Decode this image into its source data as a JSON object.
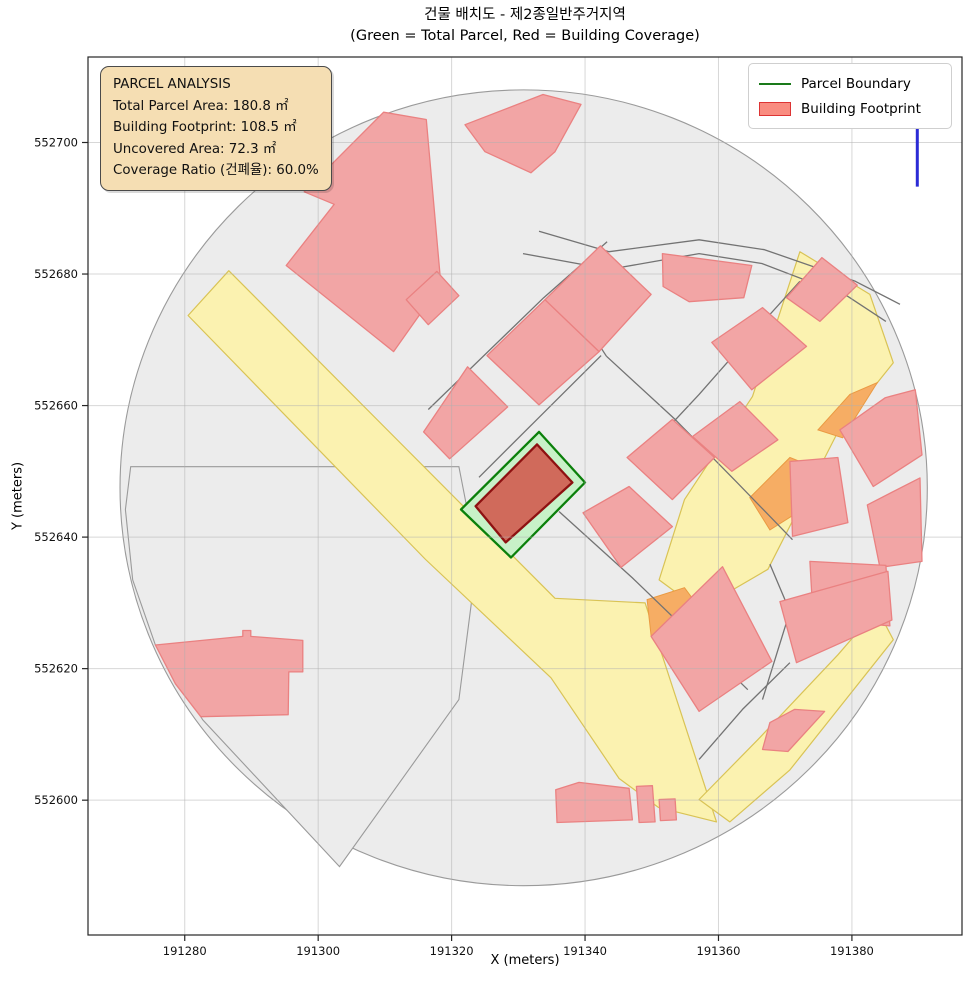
{
  "chart_data": {
    "type": "area",
    "subtype": "cadastral-parcel-map",
    "title": "건물 배치도 - 제2종일반주거지역",
    "subtitle": "(Green = Total Parcel, Red = Building Coverage)",
    "xlabel": "X (meters)",
    "ylabel": "Y (meters)",
    "xlim": [
      191265.5,
      191396.5
    ],
    "ylim": [
      552579.5,
      552713.0
    ],
    "xticks": [
      191280,
      191300,
      191320,
      191340,
      191360,
      191380
    ],
    "yticks": [
      552600,
      552620,
      552640,
      552660,
      552680,
      552700
    ],
    "grid": true,
    "legend": {
      "position": "top-right",
      "entries": [
        {
          "label": "Parcel Boundary",
          "type": "line",
          "color": "#1a7a1a"
        },
        {
          "label": "Building Footprint",
          "type": "patch",
          "color": "#f98c80",
          "edge": "#dd3434"
        }
      ]
    },
    "annotation_box": {
      "bg": "#f5deb3",
      "lines": [
        "PARCEL ANALYSIS",
        "Total Parcel Area: 180.8 ㎡",
        "Building Footprint: 108.5 ㎡",
        "Uncovered Area: 72.3 ㎡",
        "Coverage Ratio (건폐율): 60.0%"
      ]
    },
    "stats": {
      "total_parcel_area_m2": 180.8,
      "building_footprint_m2": 108.5,
      "uncovered_area_m2": 72.3,
      "coverage_ratio_pct": 60.0,
      "zoning": "제2종일반주거지역"
    },
    "north_arrow": {
      "label": "N",
      "x": 191389.8,
      "y_top": 552703.0,
      "y_bottom": 552693.3,
      "line_color": "#2b2bd6",
      "label_color": "#a3a3de"
    },
    "colors": {
      "buffer_fill": "#ececec",
      "buffer_edge": "#9a9a9a",
      "road_fill": "#fbf2b0",
      "road_edge": "#d9c355",
      "orange_fill": "#f6ad64",
      "orange_edge": "#ea9a42",
      "lot_line": "#737373",
      "building_fill": "#f2a5a5",
      "building_edge": "#ea8181",
      "parcel_fill": "#c8f1c8",
      "parcel_edge": "#0b800b",
      "target_building_fill": "#d06a5b",
      "target_building_edge": "#8e1111",
      "gridline": "rgba(175,175,175,0.5)",
      "spine": "#262626"
    },
    "layers": {
      "buffer_region_circle": {
        "center": [
          191330.8,
          552647.5
        ],
        "radius_m": 60.5
      },
      "west_parcel": [
        [
          191271.9,
          552650.7
        ],
        [
          191321.1,
          552650.7
        ],
        [
          191323.8,
          552636.6
        ],
        [
          191321.1,
          552615.3
        ],
        [
          191303.2,
          552589.9
        ],
        [
          191282.7,
          552612.2
        ],
        [
          191275.6,
          552623.6
        ],
        [
          191272.2,
          552633.5
        ],
        [
          191271.1,
          552644.2
        ]
      ],
      "roads": [
        [
          [
            191280.5,
            552673.7
          ],
          [
            191286.6,
            552680.5
          ],
          [
            191335.5,
            552630.7
          ],
          [
            191349.0,
            552630.0
          ],
          [
            191359.7,
            552596.7
          ],
          [
            191351.0,
            552598.9
          ],
          [
            191345.1,
            552603.3
          ],
          [
            191334.9,
            552618.6
          ],
          [
            191316.1,
            552636.6
          ]
        ],
        [
          [
            191372.2,
            552683.4
          ],
          [
            191382.7,
            552676.9
          ],
          [
            191386.2,
            552666.5
          ],
          [
            191377.9,
            552656.0
          ],
          [
            191367.4,
            552635.1
          ],
          [
            191357.1,
            552629.0
          ],
          [
            191351.1,
            552633.5
          ],
          [
            191354.9,
            552645.7
          ],
          [
            191365.1,
            552661.4
          ]
        ],
        [
          [
            191383.8,
            552629.0
          ],
          [
            191386.2,
            552624.4
          ],
          [
            191370.7,
            552604.6
          ],
          [
            191361.7,
            552596.7
          ],
          [
            191357.1,
            552600.1
          ],
          [
            191365.9,
            552609.2
          ],
          [
            191377.9,
            552622.1
          ]
        ]
      ],
      "road_paint_patches": [
        [
          [
            191374.9,
            552656.3
          ],
          [
            191379.7,
            552661.7
          ],
          [
            191383.8,
            552663.5
          ],
          [
            191378.6,
            552655.1
          ]
        ],
        [
          [
            191349.3,
            552630.5
          ],
          [
            191354.9,
            552632.3
          ],
          [
            191358.7,
            552627.1
          ],
          [
            191356.1,
            552623.2
          ],
          [
            191349.9,
            552625.0
          ]
        ],
        [
          [
            191364.7,
            552646.0
          ],
          [
            191370.7,
            552652.1
          ],
          [
            191375.2,
            552650.3
          ],
          [
            191374.9,
            552645.7
          ],
          [
            191367.7,
            552641.1
          ]
        ]
      ],
      "lot_lines": [
        [
          [
            191333.1,
            552686.5
          ],
          [
            191343.6,
            552683.4
          ],
          [
            191357.1,
            552685.2
          ],
          [
            191366.9,
            552683.7
          ],
          [
            191380.5,
            552678.9
          ],
          [
            191387.2,
            552675.4
          ]
        ],
        [
          [
            191330.7,
            552683.1
          ],
          [
            191343.6,
            552680.7
          ],
          [
            191357.1,
            552683.1
          ],
          [
            191366.5,
            552681.6
          ],
          [
            191379.4,
            552676.6
          ],
          [
            191385.1,
            552672.8
          ]
        ],
        [
          [
            191316.5,
            552659.4
          ],
          [
            191333.8,
            552676.4
          ],
          [
            191343.3,
            552684.9
          ]
        ],
        [
          [
            191343.2,
            552667.5
          ],
          [
            191353.5,
            552657.9
          ],
          [
            191362.7,
            552648.4
          ],
          [
            191371.1,
            552639.6
          ]
        ],
        [
          [
            191340.6,
            552671.6
          ],
          [
            191343.2,
            552667.5
          ]
        ],
        [
          [
            191347.7,
            552651.5
          ],
          [
            191357.1,
            552661.7
          ],
          [
            191365.7,
            552671.6
          ],
          [
            191372.2,
            552678.9
          ]
        ],
        [
          [
            191324.1,
            552649.1
          ],
          [
            191333.1,
            552658.2
          ],
          [
            191342.4,
            552667.6
          ]
        ],
        [
          [
            191336.1,
            552643.9
          ],
          [
            191347.1,
            552633.8
          ],
          [
            191356.7,
            552624.4
          ],
          [
            191364.4,
            552616.8
          ]
        ],
        [
          [
            191370.7,
            552620.9
          ],
          [
            191363.6,
            552613.8
          ],
          [
            191357.1,
            552606.2
          ]
        ],
        [
          [
            191367.7,
            552635.9
          ],
          [
            191370.7,
            552628.7
          ],
          [
            191366.6,
            552615.3
          ]
        ]
      ],
      "buildings": [
        [
          [
            191322.0,
            552702.7
          ],
          [
            191333.7,
            552707.3
          ],
          [
            191339.4,
            552705.8
          ],
          [
            191335.5,
            552698.6
          ],
          [
            191331.9,
            552695.4
          ],
          [
            191325.0,
            552698.6
          ]
        ],
        [
          [
            191297.9,
            552692.5
          ],
          [
            191309.8,
            552704.6
          ],
          [
            191316.2,
            552703.5
          ],
          [
            191318.4,
            552678.4
          ],
          [
            191311.3,
            552668.2
          ],
          [
            191295.2,
            552681.3
          ],
          [
            191302.4,
            552690.6
          ]
        ],
        [
          [
            191315.8,
            552656.0
          ],
          [
            191322.4,
            552665.9
          ],
          [
            191328.4,
            552659.8
          ],
          [
            191319.7,
            552651.9
          ]
        ],
        [
          [
            191325.3,
            552667.6
          ],
          [
            191334.0,
            552676.1
          ],
          [
            191342.1,
            552668.2
          ],
          [
            191333.1,
            552660.1
          ]
        ],
        [
          [
            191334.0,
            552676.1
          ],
          [
            191342.3,
            552684.3
          ],
          [
            191349.9,
            552676.9
          ],
          [
            191342.1,
            552668.2
          ]
        ],
        [
          [
            191351.6,
            552683.1
          ],
          [
            191365.0,
            552681.3
          ],
          [
            191363.8,
            552676.4
          ],
          [
            191355.6,
            552675.8
          ],
          [
            191351.7,
            552678.1
          ]
        ],
        [
          [
            191346.3,
            552652.1
          ],
          [
            191353.1,
            552657.9
          ],
          [
            191359.4,
            552652.1
          ],
          [
            191353.1,
            552645.7
          ]
        ],
        [
          [
            191339.7,
            552643.7
          ],
          [
            191346.6,
            552647.7
          ],
          [
            191353.1,
            552641.6
          ],
          [
            191345.4,
            552635.4
          ]
        ],
        [
          [
            191356.1,
            552655.3
          ],
          [
            191363.2,
            552660.6
          ],
          [
            191368.9,
            552654.8
          ],
          [
            191362.0,
            552650.0
          ]
        ],
        [
          [
            191359.0,
            552669.6
          ],
          [
            191366.6,
            552674.9
          ],
          [
            191373.2,
            552669.0
          ],
          [
            191365.0,
            552662.4
          ]
        ],
        [
          [
            191370.2,
            552676.4
          ],
          [
            191375.5,
            552682.5
          ],
          [
            191380.8,
            552678.3
          ],
          [
            191375.2,
            552672.8
          ]
        ],
        [
          [
            191378.2,
            552656.3
          ],
          [
            191385.0,
            552661.2
          ],
          [
            191389.5,
            552662.4
          ],
          [
            191390.5,
            552652.5
          ],
          [
            191383.2,
            552647.7
          ]
        ],
        [
          [
            191370.7,
            552651.5
          ],
          [
            191377.9,
            552652.1
          ],
          [
            191379.4,
            552642.2
          ],
          [
            191371.1,
            552640.1
          ]
        ],
        [
          [
            191382.3,
            552644.9
          ],
          [
            191390.2,
            552649.0
          ],
          [
            191390.5,
            552636.3
          ],
          [
            191384.2,
            552635.4
          ]
        ],
        [
          [
            191373.7,
            552636.3
          ],
          [
            191385.1,
            552635.7
          ],
          [
            191385.7,
            552626.5
          ],
          [
            191374.2,
            552627.5
          ]
        ],
        [
          [
            191349.9,
            552624.9
          ],
          [
            191360.6,
            552635.5
          ],
          [
            191368.0,
            552621.1
          ],
          [
            191357.1,
            552613.5
          ]
        ],
        [
          [
            191369.2,
            552630.2
          ],
          [
            191385.4,
            552634.8
          ],
          [
            191386.0,
            552627.4
          ],
          [
            191371.7,
            552620.9
          ]
        ],
        [
          [
            191366.6,
            552607.7
          ],
          [
            191367.7,
            552611.8
          ],
          [
            191371.4,
            552613.8
          ],
          [
            191375.9,
            552613.5
          ],
          [
            191370.4,
            552607.4
          ]
        ],
        [
          [
            191335.6,
            552601.6
          ],
          [
            191339.1,
            552602.7
          ],
          [
            191346.6,
            552601.8
          ],
          [
            191347.1,
            552597.0
          ],
          [
            191335.8,
            552596.6
          ]
        ],
        [
          [
            191347.7,
            552602.1
          ],
          [
            191350.1,
            552602.2
          ],
          [
            191350.5,
            552596.7
          ],
          [
            191348.1,
            552596.6
          ]
        ],
        [
          [
            191351.1,
            552600.1
          ],
          [
            191353.5,
            552600.2
          ],
          [
            191353.7,
            552597.0
          ],
          [
            191351.3,
            552596.9
          ]
        ],
        [
          [
            191275.6,
            552623.6
          ],
          [
            191288.7,
            552624.9
          ],
          [
            191288.7,
            552625.8
          ],
          [
            191289.9,
            552625.8
          ],
          [
            191289.9,
            552624.9
          ],
          [
            191297.7,
            552624.3
          ],
          [
            191297.7,
            552619.5
          ],
          [
            191295.6,
            552619.5
          ],
          [
            191295.5,
            552613.0
          ],
          [
            191282.4,
            552612.7
          ],
          [
            191278.6,
            552617.7
          ]
        ],
        [
          [
            191313.2,
            552676.1
          ],
          [
            191317.8,
            552680.4
          ],
          [
            191321.1,
            552676.7
          ],
          [
            191316.5,
            552672.3
          ]
        ]
      ],
      "target_parcel": [
        [
          191333.1,
          552656.0
        ],
        [
          191340.0,
          552648.3
        ],
        [
          191328.9,
          552636.9
        ],
        [
          191321.4,
          552644.2
        ]
      ],
      "target_building": [
        [
          191332.8,
          552654.1
        ],
        [
          191338.1,
          552648.3
        ],
        [
          191328.1,
          552639.2
        ],
        [
          191323.6,
          552644.7
        ]
      ]
    }
  }
}
